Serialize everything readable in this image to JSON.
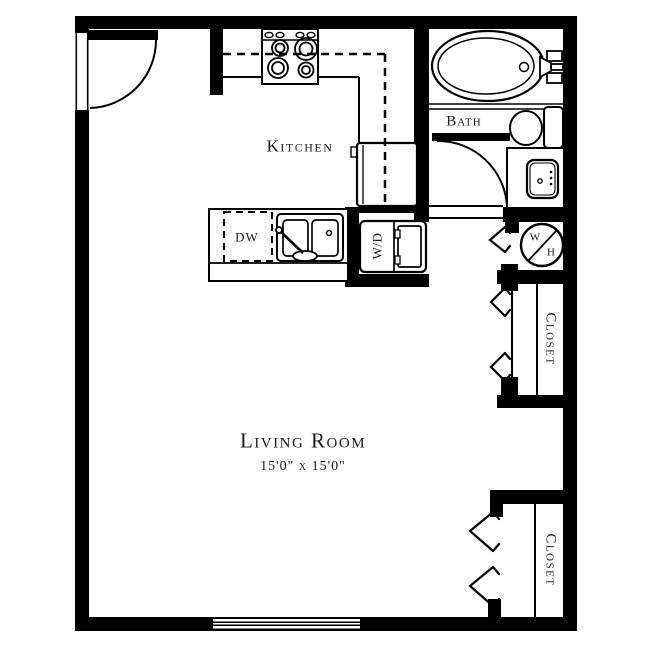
{
  "floor_plan": {
    "rooms": {
      "kitchen": "Kitchen",
      "bath": "Bath",
      "living_room": "Living Room",
      "living_room_dimensions": "15'0\" x 15'0\"",
      "closet_upper": "Closet",
      "closet_lower": "Closet"
    },
    "appliances": {
      "dishwasher": "DW",
      "washer_dryer": "W/D",
      "water_heater_w": "W",
      "water_heater_h": "H"
    },
    "colors": {
      "wall": "#000000",
      "line": "#000000",
      "text": "#1a1a1a",
      "background": "#ffffff"
    }
  }
}
